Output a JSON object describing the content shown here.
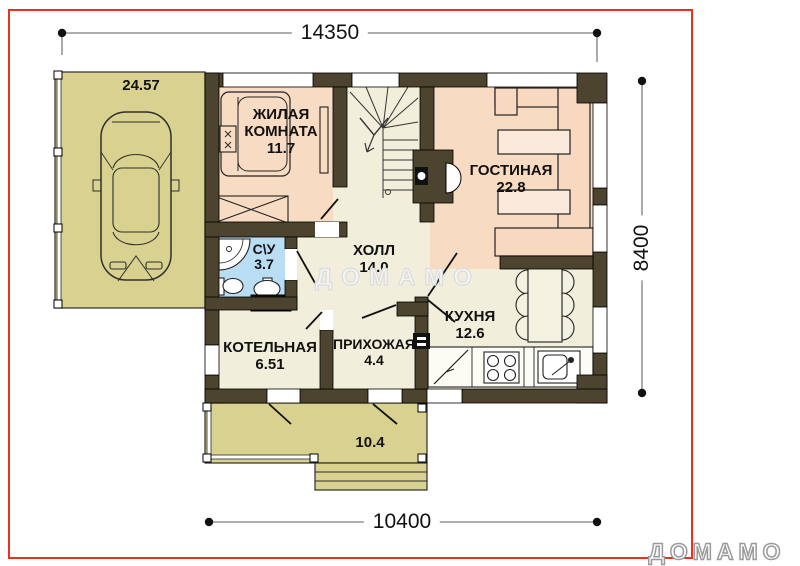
{
  "dims": {
    "width_top": "14350",
    "height_right": "8400",
    "width_bottom": "10400"
  },
  "rooms": {
    "carport": {
      "area": "24.57"
    },
    "bedroom": {
      "name": "ЖИЛАЯ КОМНАТА",
      "area": "11.7"
    },
    "living": {
      "name": "ГОСТИНАЯ",
      "area": "22.8"
    },
    "bathroom": {
      "name": "С\\У",
      "area": "3.7"
    },
    "hall": {
      "name": "ХОЛЛ",
      "area": "14.0"
    },
    "kitchen": {
      "name": "КУХНЯ",
      "area": "12.6"
    },
    "boiler": {
      "name": "КОТЕЛЬНАЯ",
      "area": "6.51"
    },
    "entry": {
      "name": "ПРИХОЖАЯ",
      "area": "4.4"
    },
    "terrace": {
      "area": "10.4"
    }
  },
  "watermark": "ДОМАМО",
  "brand_logo": "ДОМАМО",
  "colors": {
    "wall": "#4d4430",
    "room_warm": "#f8dbc3",
    "room_cream": "#f1efdb",
    "room_wet": "#b9ddf3",
    "outdoor": "#d9d18f",
    "frame_red": "#e8321e"
  }
}
